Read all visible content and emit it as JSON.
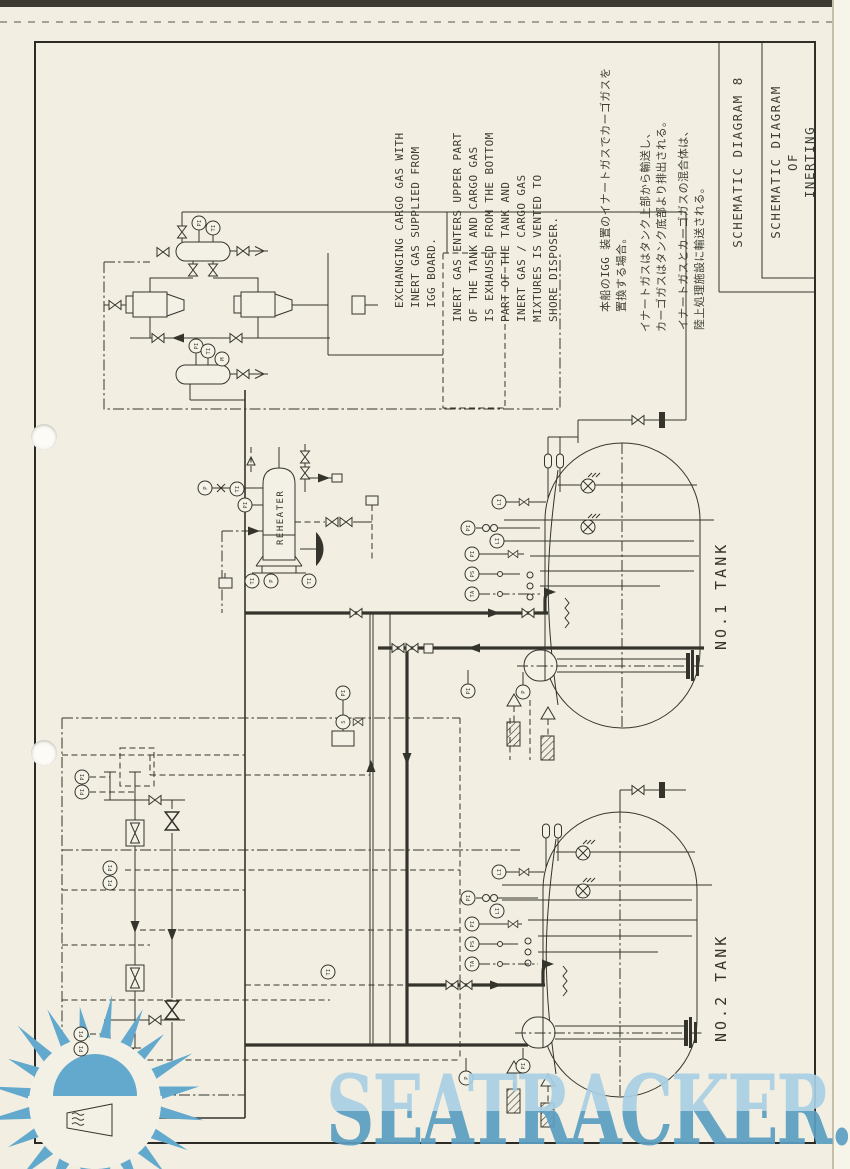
{
  "page": {
    "watermark_text": "SEATRACKER.RU",
    "colors": {
      "paper": "#f2efe2",
      "ink": "#35342c",
      "watermark_blue": "#5b9ec2",
      "watermark_light": "#a9cfe4",
      "sun_blue": "#63a9cd"
    }
  },
  "title_block": {
    "drawing_no": "SCHEMATIC DIAGRAM 8",
    "title_lines": [
      "SCHEMATIC DIAGRAM",
      "OF",
      "INERTING"
    ]
  },
  "notes": {
    "en_note1_lines": [
      "EXCHANGING CARGO GAS WITH",
      "INERT GAS SUPPLIED FROM",
      "IGG BOARD."
    ],
    "en_note2_lines": [
      "INERT GAS ENTERS UPPER PART",
      "OF THE TANK AND CARGO GAS",
      "IS EXHAUSED FROM THE BOTTOM",
      "PART OF THE TANK AND",
      "INERT GAS / CARGO GAS",
      "MIXTURES IS VENTED TO",
      "SHORE DISPOSER."
    ],
    "ja_note1_lines": [
      "本船のIGG 装置のイナートガスでカーゴガスを",
      "置換する場合。"
    ],
    "ja_note2_lines": [
      "イナートガスはタンク上部から輸送し、",
      "カーゴガスはタンク底部より排出される。"
    ],
    "ja_note3_lines": [
      "イナートガスとカーゴガスの混合体は、",
      "陸上処理施設に輸送される。"
    ]
  },
  "equipment": {
    "reheater_label": "REHEATER",
    "tank1_label": "NO.1 TANK",
    "tank2_label": "NO.2 TANK"
  },
  "instruments": [
    {
      "x": 199,
      "y": 223,
      "label": "PI"
    },
    {
      "x": 213,
      "y": 228,
      "label": "TI"
    },
    {
      "x": 196,
      "y": 346,
      "label": "PI"
    },
    {
      "x": 208,
      "y": 351,
      "label": "TI"
    },
    {
      "x": 222,
      "y": 359,
      "label": "M"
    },
    {
      "x": 205,
      "y": 488,
      "label": "P"
    },
    {
      "x": 237,
      "y": 489,
      "label": "TI"
    },
    {
      "x": 245,
      "y": 505,
      "label": "PI"
    },
    {
      "x": 252,
      "y": 581,
      "label": "TI"
    },
    {
      "x": 271,
      "y": 581,
      "label": "P"
    },
    {
      "x": 309,
      "y": 581,
      "label": "TI"
    },
    {
      "x": 343,
      "y": 693,
      "label": "PI"
    },
    {
      "x": 343,
      "y": 722,
      "label": "S"
    },
    {
      "x": 499,
      "y": 502,
      "label": "LI"
    },
    {
      "x": 468,
      "y": 528,
      "label": "PI"
    },
    {
      "x": 497,
      "y": 541,
      "label": "LI"
    },
    {
      "x": 472,
      "y": 554,
      "label": "PI"
    },
    {
      "x": 472,
      "y": 574,
      "label": "PS"
    },
    {
      "x": 472,
      "y": 594,
      "label": "TA"
    },
    {
      "x": 468,
      "y": 691,
      "label": "PI"
    },
    {
      "x": 523,
      "y": 692,
      "label": "P"
    },
    {
      "x": 499,
      "y": 872,
      "label": "LI"
    },
    {
      "x": 468,
      "y": 898,
      "label": "PI"
    },
    {
      "x": 497,
      "y": 911,
      "label": "LI"
    },
    {
      "x": 472,
      "y": 924,
      "label": "PI"
    },
    {
      "x": 472,
      "y": 944,
      "label": "PS"
    },
    {
      "x": 472,
      "y": 964,
      "label": "TA"
    },
    {
      "x": 466,
      "y": 1078,
      "label": "P"
    },
    {
      "x": 523,
      "y": 1066,
      "label": "PI"
    },
    {
      "x": 82,
      "y": 777,
      "label": "PI"
    },
    {
      "x": 82,
      "y": 792,
      "label": "PI"
    },
    {
      "x": 110,
      "y": 868,
      "label": "PI"
    },
    {
      "x": 110,
      "y": 883,
      "label": "PI"
    },
    {
      "x": 81,
      "y": 1034,
      "label": "PI"
    },
    {
      "x": 81,
      "y": 1049,
      "label": "PI"
    },
    {
      "x": 328,
      "y": 972,
      "label": "TI"
    }
  ]
}
